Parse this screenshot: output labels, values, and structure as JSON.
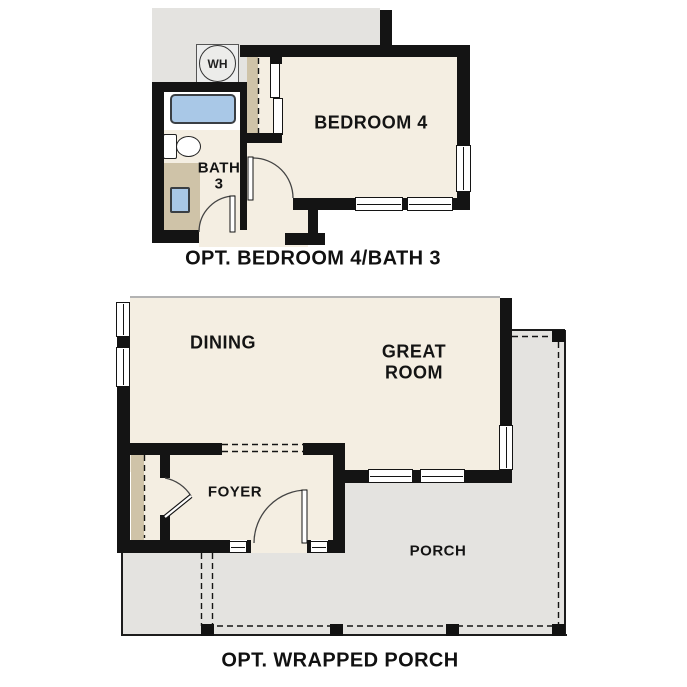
{
  "plan_bedroom4": {
    "caption": "OPT. BEDROOM 4/BATH 3",
    "labels": {
      "bedroom": "BEDROOM 4",
      "bath_line1": "BATH",
      "bath_line2": "3",
      "water_heater": "WH"
    }
  },
  "plan_porch": {
    "caption": "OPT. WRAPPED PORCH",
    "labels": {
      "dining": "DINING",
      "great_room_line1": "GREAT",
      "great_room_line2": "ROOM",
      "foyer": "FOYER",
      "porch": "PORCH"
    }
  },
  "colors": {
    "background": "#ffffff",
    "wall": "#141414",
    "room_fill": "#f4eee2",
    "existing_structure_fill": "#e4e3e0",
    "porch_fill": "#e4e3e0",
    "fixture_blue": "#a9c8e7",
    "cabinet_tan": "#cfc3a8",
    "text": "#111111"
  }
}
